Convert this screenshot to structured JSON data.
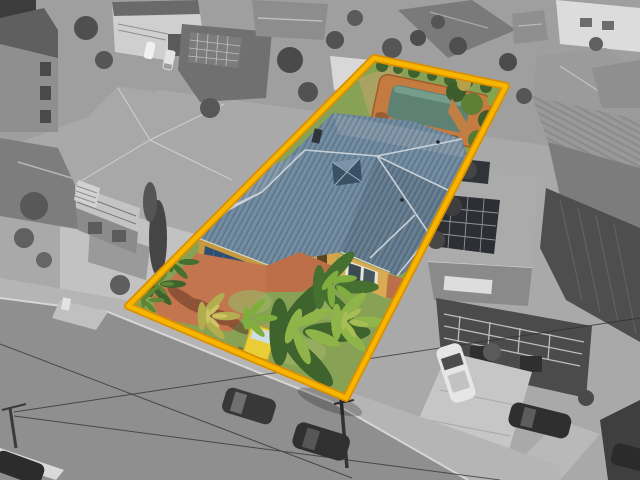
{
  "image": {
    "kind": "aerial-real-estate-photograph",
    "style": "selective colour: featured lot in colour, surroundings desaturated greyscale",
    "visible_text": "",
    "width_px": 640,
    "height_px": 480
  },
  "property": {
    "boundary": "rotated rectangle outlined in yellow",
    "features": [
      "blue-tile hip roof house",
      "central pyramid skylight",
      "double garage with blue door",
      "terracotta brick driveway",
      "front lawn with palm trees",
      "yellow for-sale signboard",
      "backyard swimming pool with terracotta paving",
      "dry back lawn",
      "garden shrubs"
    ]
  },
  "surroundings": {
    "road": "grey asphalt street crossing lower-left with power lines and utility poles",
    "parked_cars_count": 8,
    "neighbour_features": [
      "multi-storey houses",
      "solar panel roof",
      "balcony house",
      "pergola roof",
      "white carport",
      "concrete driveways",
      "grey palms and cypress trees"
    ]
  },
  "colors": {
    "boundary": "#F6B600",
    "boundary_edge": "#DB8F00",
    "roof_main": "#6D879D",
    "roof_light": "#7E94A6",
    "roof_ridge": "#C9D1D8",
    "skylight": "#3A5064",
    "wall": "#D8AB52",
    "wall_shade": "#C7993F",
    "garage_door": "#2E4E74",
    "driveway": "#C3764E",
    "entry_path": "#BD7048",
    "pool_water": "#5D8173",
    "pool_deck": "#C57B3F",
    "lawn": "#87A254",
    "lawn_light": "#9DB163",
    "dry_grass": "#A9A262",
    "palm_dark": "#3E632C",
    "palm_mid": "#5F8634",
    "palm_light": "#8FB54A",
    "palm_yellow": "#B2AD4E",
    "sign_yellow": "#E9CE3A",
    "sign_panel": "#CFDDE4",
    "road": "#8F8F8F",
    "footpath": "#B5B5B5",
    "concrete": "#C6C6C6"
  }
}
